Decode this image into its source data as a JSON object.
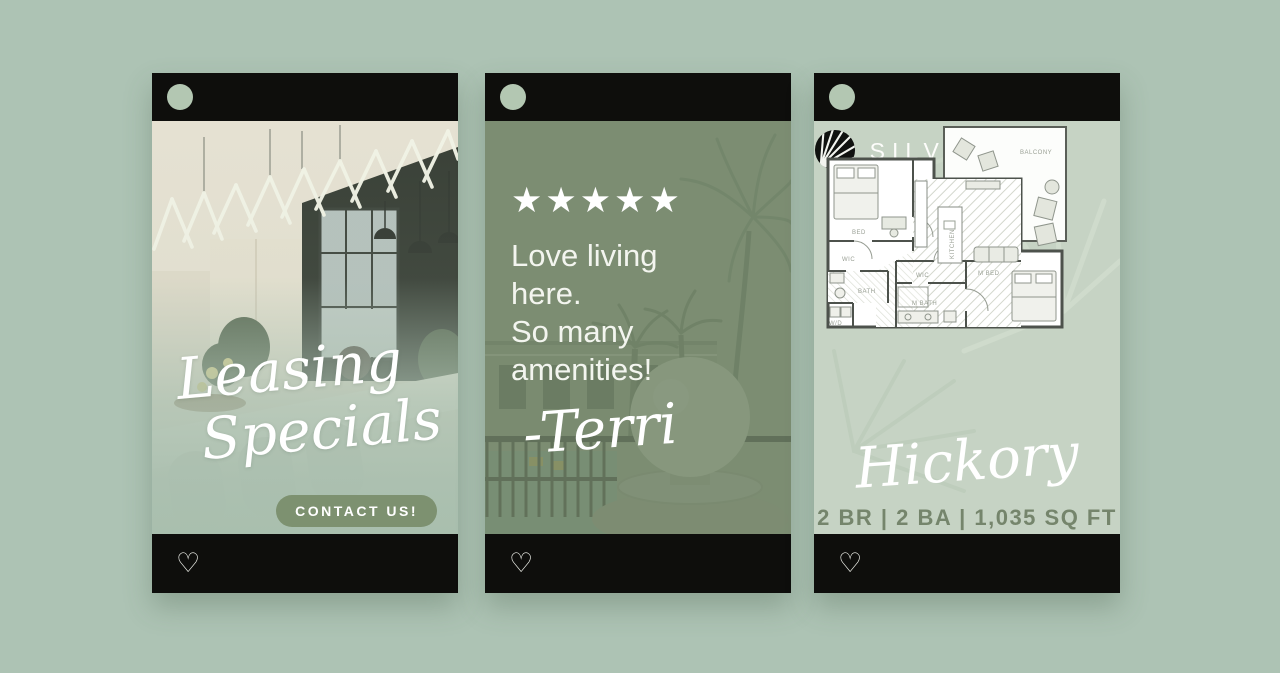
{
  "icons": {
    "heart": "♡"
  },
  "colors": {
    "background": "#adc3b4",
    "bar_black": "#0e0e0c",
    "avatar_sage": "#b3c7b2",
    "button_green": "#7d9170",
    "overlay_green": "#76886c",
    "specs_text": "#75856c",
    "star_white": "#ffffff"
  },
  "post1": {
    "title_line1": "Leasing",
    "title_line2": "Specials",
    "cta_label": "CONTACT US!"
  },
  "post2": {
    "rating": "★★★★★",
    "quote_line1": "Love living",
    "quote_line2": "here.",
    "quote_line3": "So many",
    "quote_line4": "amenities!",
    "signature": "-Terri"
  },
  "post3": {
    "brand": "SILVERSAW",
    "floorplan_name": "Hickory",
    "specs": "2 BR | 2 BA | 1,035 SQ FT",
    "plan_labels": {
      "bed": "BED",
      "wic": "WIC",
      "bath": "BATH",
      "wd": "W/D",
      "kitchen": "KITCHEN",
      "balcony": "BALCONY",
      "m_bed": "M BED",
      "m_bath": "M BATH",
      "wic2": "WIC"
    }
  }
}
